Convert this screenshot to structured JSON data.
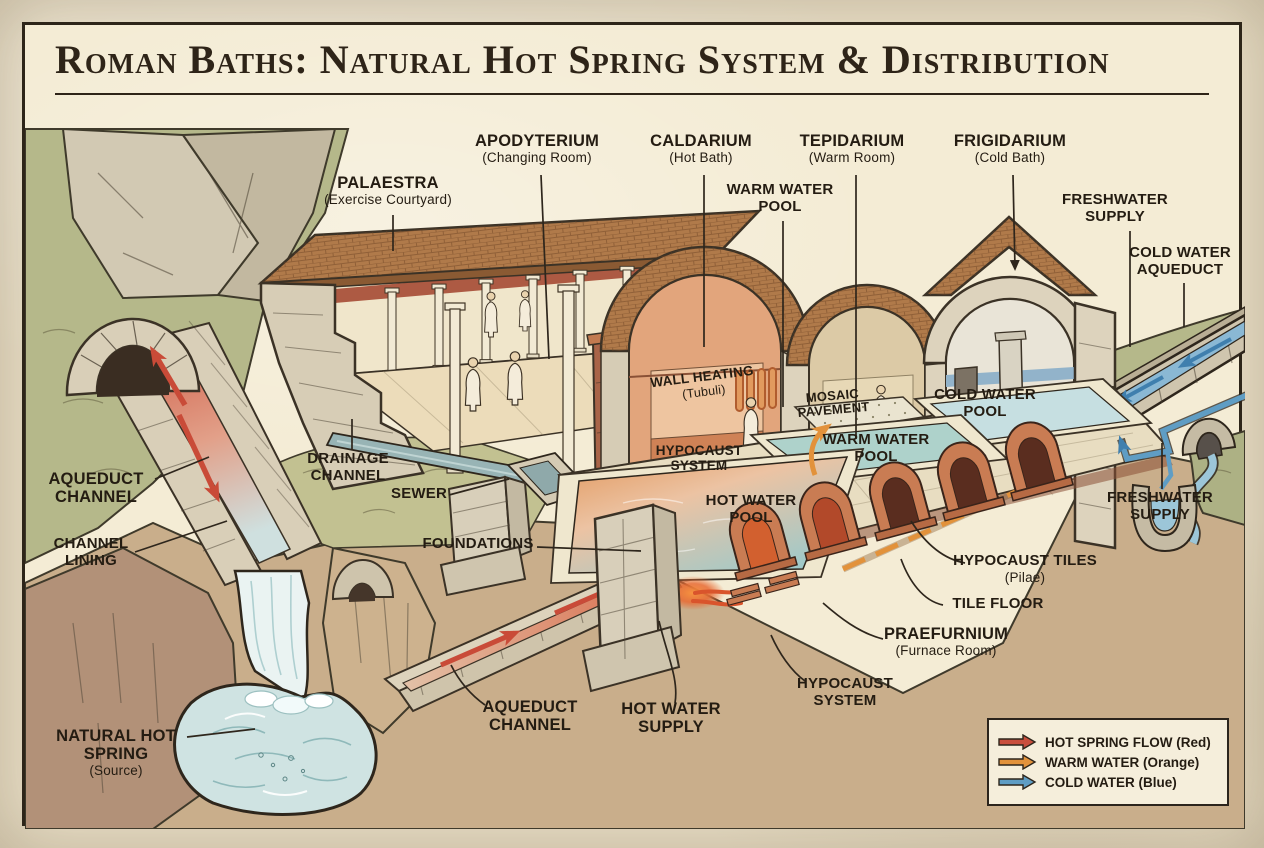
{
  "title": "Roman Baths: Natural Hot Spring System & Distribution",
  "labels": {
    "palaestra": {
      "title": "PALAESTRA",
      "sub": "(Exercise Courtyard)"
    },
    "apodyterium": {
      "title": "APODYTERIUM",
      "sub": "(Changing Room)"
    },
    "caldarium": {
      "title": "CALDARIUM",
      "sub": "(Hot Bath)"
    },
    "tepidarium": {
      "title": "TEPIDARIUM",
      "sub": "(Warm Room)"
    },
    "frigidarium": {
      "title": "FRIGIDARIUM",
      "sub": "(Cold Bath)"
    },
    "warm_water_pool_top": {
      "title": "WARM WATER POOL"
    },
    "freshwater_supply_top": {
      "title": "FRESHWATER SUPPLY"
    },
    "cold_water_aqueduct": {
      "title": "COLD WATER AQUEDUCT"
    },
    "aqueduct_channel_left": {
      "title": "AQUEDUCT CHANNEL"
    },
    "channel_lining": {
      "title": "CHANNEL LINING"
    },
    "drainage_channel": {
      "title": "DRAINAGE CHANNEL"
    },
    "sewer": {
      "title": "SEWER"
    },
    "foundations": {
      "title": "FOUNDATIONS"
    },
    "wall_heating": {
      "title": "WALL HEATING",
      "sub": "(Tubuli)"
    },
    "hypocaust_system_caldarium": {
      "title": "HYPOCAUST SYSTEM"
    },
    "hot_water_pool": {
      "title": "HOT WATER POOL"
    },
    "mosaic_pavement": {
      "title": "MOSAIC PAVEMENT"
    },
    "warm_water_pool_center": {
      "title": "WARM WATER POOL"
    },
    "cold_water_pool": {
      "title": "COLD WATER POOL"
    },
    "freshwater_supply_right": {
      "title": "FRESHWATER SUPPLY"
    },
    "hypocaust_tiles": {
      "title": "HYPOCAUST TILES",
      "sub": "(Pilae)"
    },
    "tile_floor": {
      "title": "TILE FLOOR"
    },
    "praefurnium": {
      "title": "PRAEFURNIUM",
      "sub": "(Furnace Room)"
    },
    "hypocaust_system_bottom": {
      "title": "HYPOCAUST SYSTEM"
    },
    "aqueduct_channel_bottom": {
      "title": "AQUEDUCT CHANNEL"
    },
    "hot_water_supply": {
      "title": "HOT WATER SUPPLY"
    },
    "natural_hot_spring": {
      "title": "NATURAL HOT SPRING",
      "sub": "(Source)"
    }
  },
  "legend": {
    "items": [
      {
        "label": "HOT SPRING FLOW (Red)",
        "color": "#c94f3d",
        "icon": "arrow-right-red"
      },
      {
        "label": "WARM WATER (Orange)",
        "color": "#e2923b",
        "icon": "arrow-right-orange"
      },
      {
        "label": "COLD WATER (Blue)",
        "color": "#5f9dc4",
        "icon": "arrow-right-blue"
      }
    ]
  },
  "palette": {
    "paper": "#e9dfc7",
    "panel": "#f4ecd5",
    "ink": "#2e2418",
    "hill_green": "#b5b88a",
    "rock": "#d2c9b3",
    "earth_left": "#b29178",
    "earth_center": "#c9ae8b",
    "earth_right": "#aa8a69",
    "stone": "#d9cfb8",
    "roof": "#b07a4a",
    "water": "#cfe3e2",
    "hot_red": "#c94f3d",
    "warm_orange": "#e2923b",
    "cold_blue": "#5f9dc4"
  }
}
